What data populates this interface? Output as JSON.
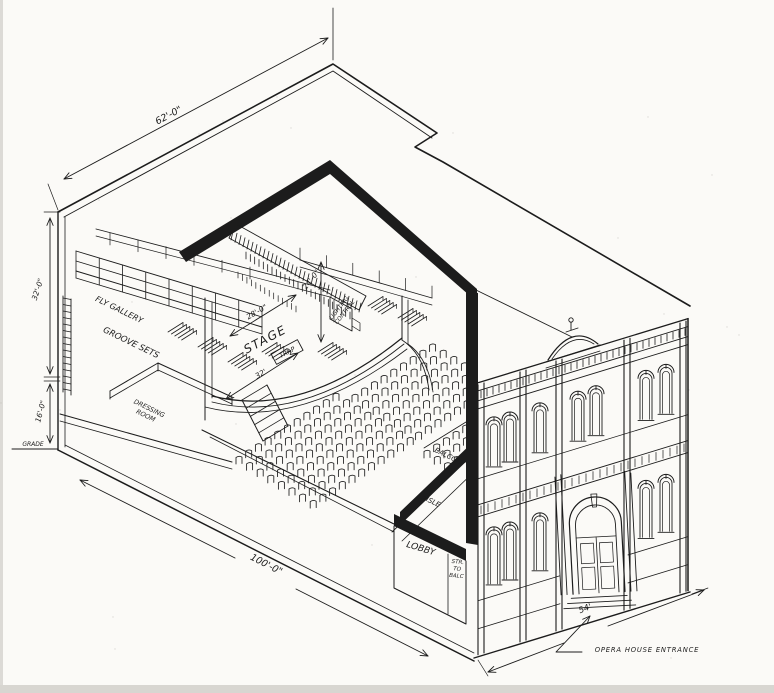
{
  "drawing": {
    "labels": {
      "grade": "GRADE",
      "fly_gallery": "FLY GALLERY",
      "groove_sets": "GROOVE SETS",
      "dressing_room_line1": "DRESSING",
      "dressing_room_line2": "ROOM",
      "stage": "STAGE",
      "trap": "TRAP",
      "lighting_line1": "LIGHTING",
      "lighting_line2": "CONTROL",
      "balcony": "BALCONY",
      "aisle": "AISLE",
      "lobby": "LOBBY",
      "stairs_line1": "STR.",
      "stairs_line2": "TO",
      "stairs_line3": "BALC",
      "entrance": "OPERA HOUSE ENTRANCE"
    },
    "dimensions": {
      "roof_length": "62'-0\"",
      "stagehouse_height": "32'-0\"",
      "understage_height": "16'-0\"",
      "stage_depth": "28'-0\"",
      "proscenium_height": "24'-0\"",
      "apron_width": "32'",
      "building_length": "100'-0\"",
      "facade_width": "54'"
    },
    "colors": {
      "ink": "#1c1c1c",
      "paper": "#fbfaf7"
    }
  }
}
